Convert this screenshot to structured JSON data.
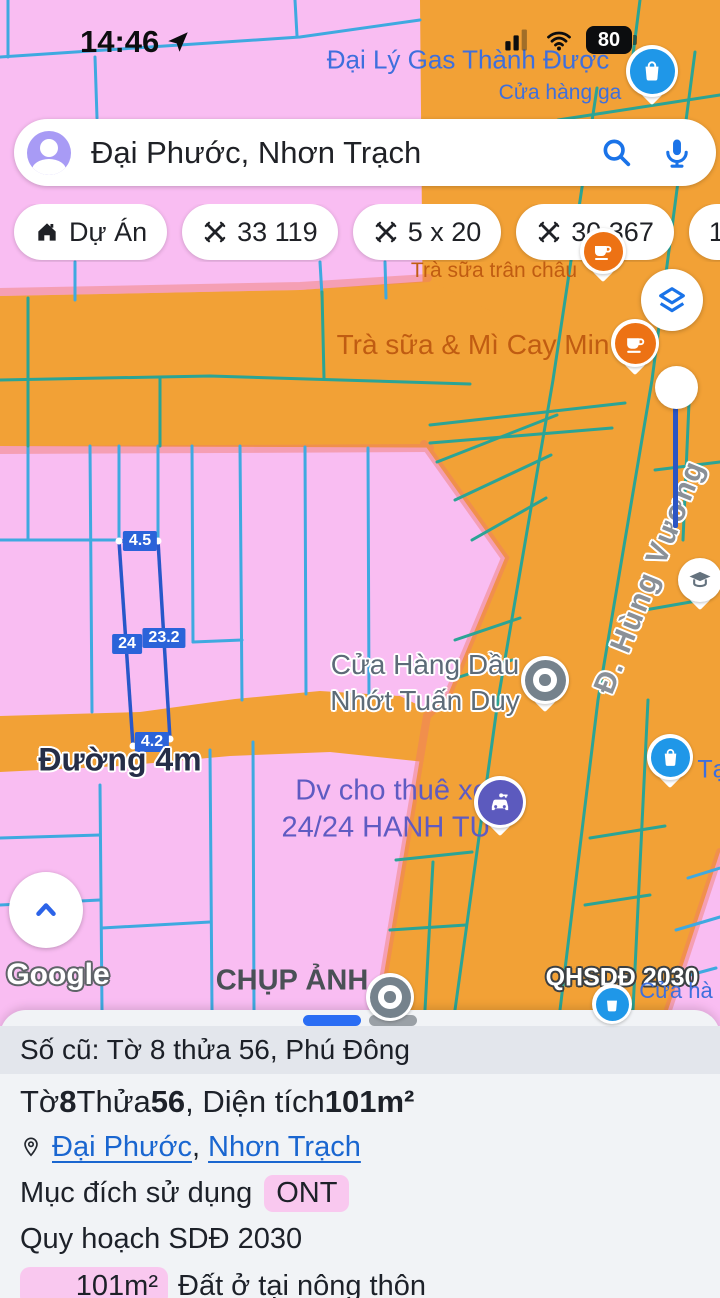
{
  "status_bar": {
    "time": "14:46",
    "battery": "80"
  },
  "search": {
    "query": "Đại Phước, Nhơn Trạch"
  },
  "chips": [
    {
      "label": "Dự Án"
    },
    {
      "label": "33 119"
    },
    {
      "label": "5 x 20"
    },
    {
      "label": "30 367"
    },
    {
      "label": "100m² t"
    }
  ],
  "map": {
    "labels": {
      "gas_title": "Đại Lý Gas Thành Được",
      "gas_sub": "Cửa hàng ga",
      "tea_small": "Trà sữa trân châu",
      "tea_big": "Trà sữa & Mì Cay Min",
      "street": "Đ. Hùng Vương",
      "oil_l1": "Cửa Hàng Dầu",
      "oil_l2": "Nhớt Tuấn Duy",
      "road": "Đường 4m",
      "rental_l1": "Dv cho thuê xe",
      "rental_l2": "24/24 HANH TÚ",
      "photo": "CHỤP ẢNH",
      "qhsdd": "QHSDĐ 2030",
      "cua_ha": "Cửa hà",
      "ta": "Tạ",
      "watermark": "Google"
    },
    "parcel": {
      "top": "4.5",
      "left": "24",
      "right": "23.2",
      "bottom": "4.2"
    }
  },
  "panel": {
    "old_ref": "Số cũ: Tờ 8 thửa 56, Phú Đông",
    "title": {
      "p1": "Tờ ",
      "b1": "8",
      "p2": " Thửa ",
      "b2": "56",
      "p3": ", Diện tích ",
      "b3": "101m²"
    },
    "location": {
      "link1": "Đại Phước",
      "sep": ", ",
      "link2": "Nhơn Trạch"
    },
    "usage": {
      "label": "Mục đích sử dụng",
      "value": "ONT"
    },
    "plan": "Quy hoạch SDĐ 2030",
    "area": {
      "badge": "101m²",
      "desc": "Đất ở tại nông thôn"
    }
  },
  "colors": {
    "zone_residential_pink": "#f9bdf2",
    "zone_commercial_orange": "#f2a136",
    "parcel_line_on_pink": "#3fa9e0",
    "parcel_line_on_orange": "#2ba495",
    "measure_highlight_blue": "#2b63d9",
    "accent_blue": "#1a73e8",
    "badge_pink": "#f9c8ef",
    "link_blue": "#1a66d0",
    "label_orange": "#c05c12",
    "label_purple": "#5f5bc2"
  }
}
